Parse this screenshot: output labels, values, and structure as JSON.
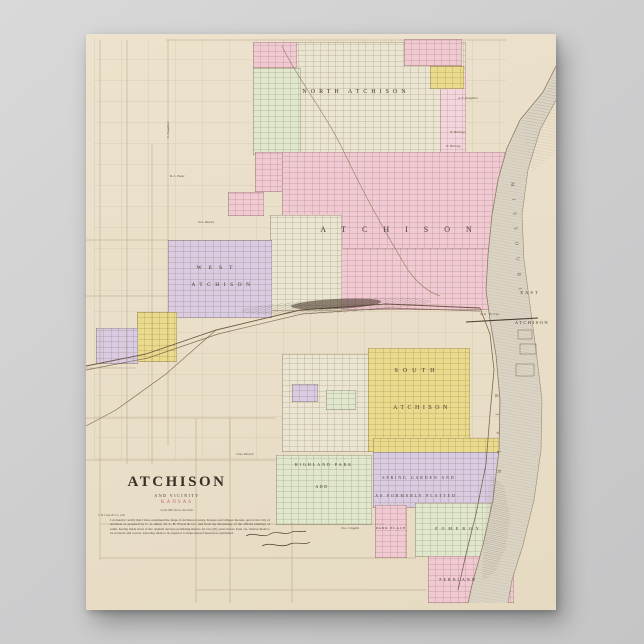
{
  "poster": {
    "map_title": "ATCHISON",
    "map_subtitle": "AND VICINITY",
    "map_region": "KANSAS",
    "scale_note": "Scale 600 feet to the inch.",
    "publisher_note": "J. B. Cook & Co., Lith.",
    "certification": "I do hereby certify that I have examined the maps of Atchison County, Kansas and villages therein, and of the City of Atchison as prepared by C. A. Allen, for L. H. Everts & Co., and from my knowledge of the official plattings of same, having made most of the original surveys pertaining thereto for ten (10) years before June 1st, believe them to be accurate and correct, knowing them to be superior to maps thereof heretofore published."
  },
  "districts": {
    "north": {
      "label": "NORTH ATCHISON"
    },
    "main": {
      "label": "ATCHISON"
    },
    "west": {
      "line1": "WEST",
      "line2": "ATCHISON"
    },
    "south": {
      "line1": "SOUTH",
      "line2": "ATCHISON"
    },
    "east": {
      "line1": "EAST",
      "line2": "ATCHISON"
    },
    "spring_garden": {
      "line1": "SPRING GARDEN AND",
      "line2": "AS FORMERLY PLATTED"
    },
    "highland_park": {
      "line1": "HIGHLAND PARK",
      "line2": "ADD"
    },
    "park_place": {
      "label": "PARK PLACE"
    },
    "pomeroy": {
      "label": "POMEROY"
    },
    "fernland": {
      "label": "FERNLAND"
    }
  },
  "river": {
    "name_upper": "MISSOURI",
    "name_lower": "RIVER",
    "bridge_label": "R.R. Bridge"
  },
  "owners": [
    {
      "text": "A. F. Stoughton"
    },
    {
      "text": "W. Hartwig"
    },
    {
      "text": "H. Hartwig"
    },
    {
      "text": "R. L. Pease"
    },
    {
      "text": "Geo. Rawley"
    },
    {
      "text": "Chas. Howell"
    },
    {
      "text": "Jno. J. Ingalls"
    },
    {
      "text": "E. Stoughton"
    }
  ],
  "colors": {
    "background": "#cdcdce",
    "paper": "#ebe1cb",
    "pink": "#f1c9d3",
    "yellow": "#eada8b",
    "purple": "#d8cbe2",
    "green": "#dfe7cd",
    "river": "#dbd4c5",
    "ink": "#42382c",
    "title_red": "#bb6272"
  }
}
